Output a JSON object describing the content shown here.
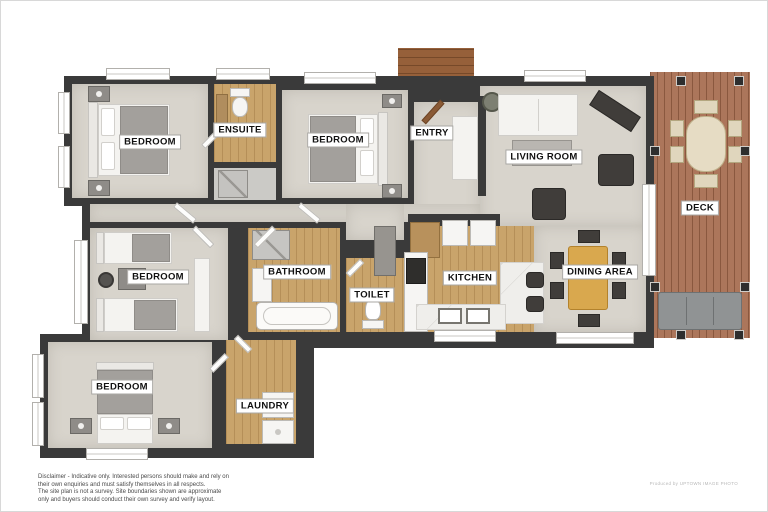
{
  "plan": {
    "rooms": {
      "bedroom1": "BEDROOM",
      "ensuite": "ENSUITE",
      "bedroom2": "BEDROOM",
      "entry": "ENTRY",
      "living_room": "LIVING ROOM",
      "deck": "DECK",
      "bedroom3": "BEDROOM",
      "bathroom": "BATHROOM",
      "toilet": "TOILET",
      "kitchen": "KITCHEN",
      "dining_area": "DINING AREA",
      "bedroom4": "BEDROOM",
      "laundry": "LAUNDRY"
    },
    "colors": {
      "wall": "#3a3a3a",
      "carpet_floor": "#d8d4cc",
      "timber_floor": "#c9a46b",
      "deck_timber": "#a86f52",
      "dining_table": "#d9a84e",
      "label_background": "#ffffff"
    },
    "footer": {
      "disclaimer_lines": [
        "Disclaimer - Indicative only. Interested persons should make and rely on",
        "their own enquiries and must satisfy themselves in all respects.",
        "The site plan is not a survey. Site boundaries shown are approximate",
        "only and buyers should conduct their own survey and verify layout."
      ],
      "credit": "Produced by UPTOWN IMAGE PHOTO"
    }
  }
}
